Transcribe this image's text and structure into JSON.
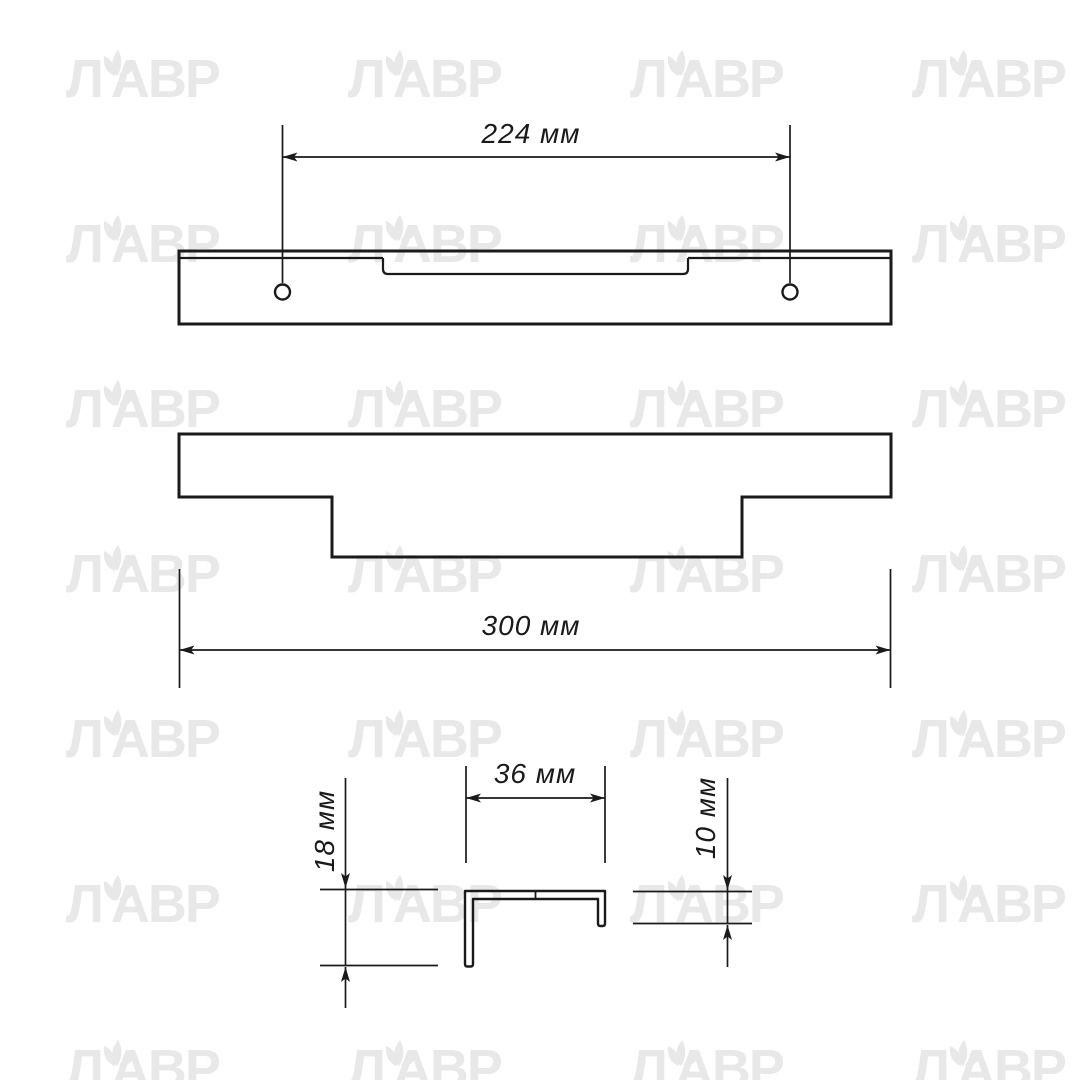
{
  "page": {
    "background": "#ffffff"
  },
  "watermark": {
    "part_l": "Л",
    "part_avr": "АВР",
    "color": "#e8e8e8"
  },
  "drawing": {
    "line_color": "#1a1a1a",
    "top_view": {
      "hole_spacing_label": "224 мм"
    },
    "front_view": {
      "length_label": "300 мм"
    },
    "section_view": {
      "width_label": "36 мм",
      "height_label": "18 мм",
      "lip_label": "10 мм"
    }
  }
}
